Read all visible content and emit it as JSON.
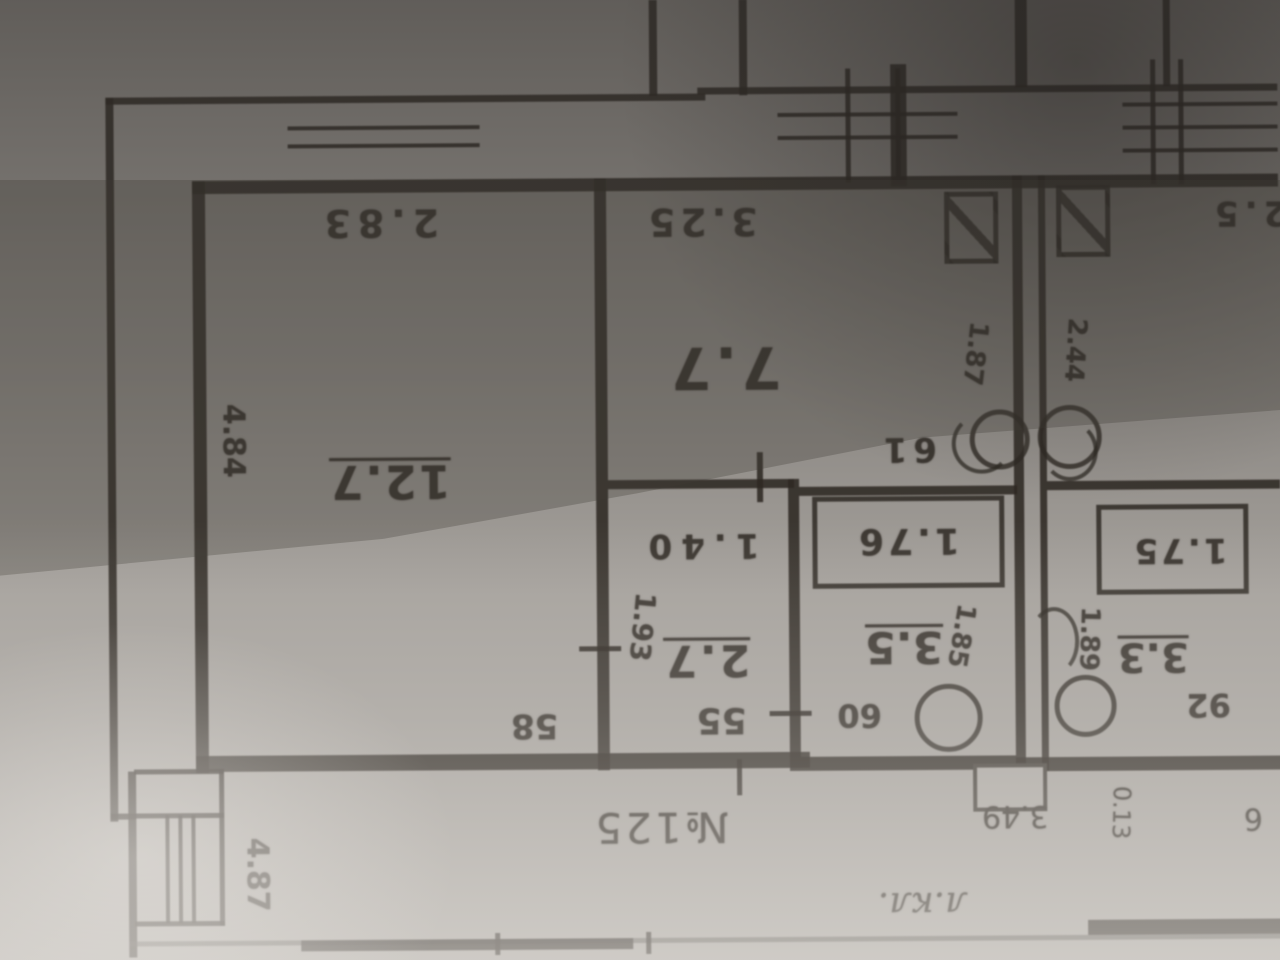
{
  "plan": {
    "rooms": {
      "living": {
        "area": "12.7",
        "width": "2.83",
        "depth": "4.84",
        "door": "58"
      },
      "bedroom": {
        "area": "7.7",
        "width": "3.25",
        "door": "61"
      },
      "corridor": {
        "area": "2.7",
        "width": "1.40",
        "depth": "1.93",
        "door": "55"
      },
      "bathroom": {
        "area": "3.5",
        "bathtub": "1.76",
        "door": "60",
        "side": "1.85"
      },
      "toilet": {
        "area": "3.3",
        "bathtub": "1.75",
        "door": "92",
        "side": "1.89"
      },
      "neighbor": {
        "area": "2.5",
        "side": "2.44"
      }
    },
    "shaft_note": "1.87",
    "exterior": {
      "left_dim": "4.87"
    },
    "landing": {
      "apartment_number": "№125",
      "stair_note": "л.кл.",
      "dim": "3.49",
      "dim_small": "0.13",
      "mark": "6"
    }
  }
}
